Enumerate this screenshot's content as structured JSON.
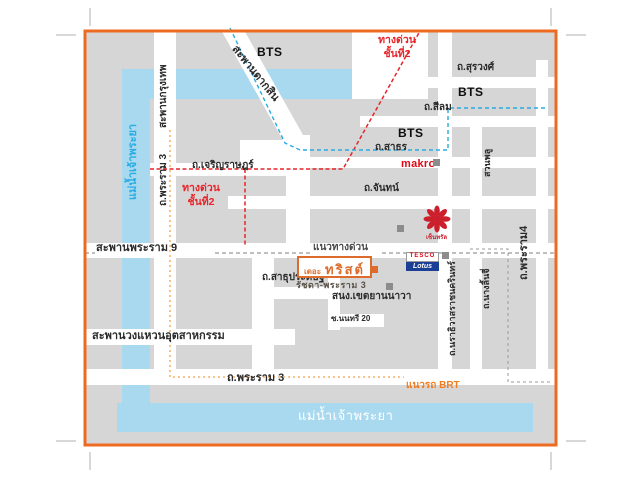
{
  "project": {
    "name_prefix": "เดอะ",
    "name": "ทริสต์",
    "subtitle": "รัชดา-พระราม 3"
  },
  "river": {
    "name": "แม่น้ำเจ้าพระยา"
  },
  "bridges": {
    "krung_thep": "สะพานกรุงเทพ",
    "taksin": "สะพานตากสิน",
    "rama9": "สะพานพระราม 9",
    "industrial_ring": "สะพานวงแหวนอุตสาหกรรม"
  },
  "roads": {
    "surawong": "ถ.สุรวงศ์",
    "silom": "ถ.สีลม",
    "sathorn": "ถ.สาธร",
    "chan": "ถ.จันทน์",
    "charoen_rat": "ถ.เจริญราษฎร์",
    "sathu_pradit": "ถ.สาธุประดิษฐ์",
    "rama3": "ถ.พระราม 3",
    "rama4": "ถ.พระราม4",
    "narathiwas": "ถ.นราธิวาสราชนครินทร์",
    "nang_linchi": "ถ.นางลิ้นจี่",
    "suan_phlu": "สวนพลู",
    "soi_nonsi": "ซ.นนทรี 20"
  },
  "transit": {
    "bts": "BTS",
    "expressway_stack": "ทางด่วน\nชั้นที่2",
    "expressway_line": "แนวทางด่วน",
    "brt_line": "แนวรถ BRT"
  },
  "places": {
    "makro": "makro",
    "tesco": "TESCO",
    "lotus": "Lotus",
    "central": "เซ็นทรัล",
    "district_office": "สนง.เขตยานนาวา"
  },
  "colors": {
    "frame_orange": "#ed6b21",
    "river_blue": "#a9d9ef",
    "river_text_blue": "#2bace3",
    "block_gray": "#d6d6d6",
    "road_white": "#ffffff",
    "bts_line_blue": "#29abe2",
    "expressway_red": "#e8252a",
    "brt_orange": "#f6b26b",
    "brt_label_orange": "#f07d1f",
    "dash_gray": "#999999",
    "makro_red": "#e30613",
    "trust_orange": "#dd6b2b"
  }
}
